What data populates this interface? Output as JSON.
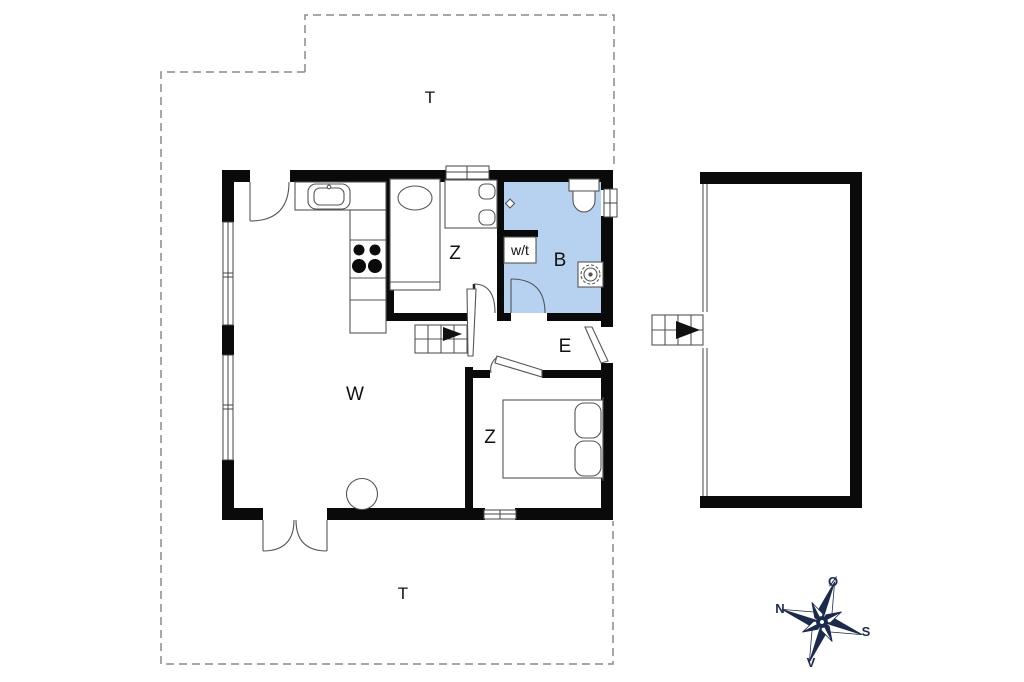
{
  "plan_title": "holiday-house-floor-plan",
  "labels": {
    "terrace_top": "T",
    "terrace_bottom": "T",
    "living_room": "W",
    "bedroom_north": "Z",
    "bedroom_south": "Z",
    "bathroom": "B",
    "entrance": "E",
    "utility": "w/t"
  },
  "compass": {
    "north": "N",
    "south": "S",
    "east": "Ø",
    "west": "V"
  },
  "colors": {
    "bathroom_fill": "#b7d1f0",
    "wall": "#0a0a0a",
    "compass": "#1c2b4d",
    "boundary": "#8a8a8a",
    "text": "#111111"
  }
}
